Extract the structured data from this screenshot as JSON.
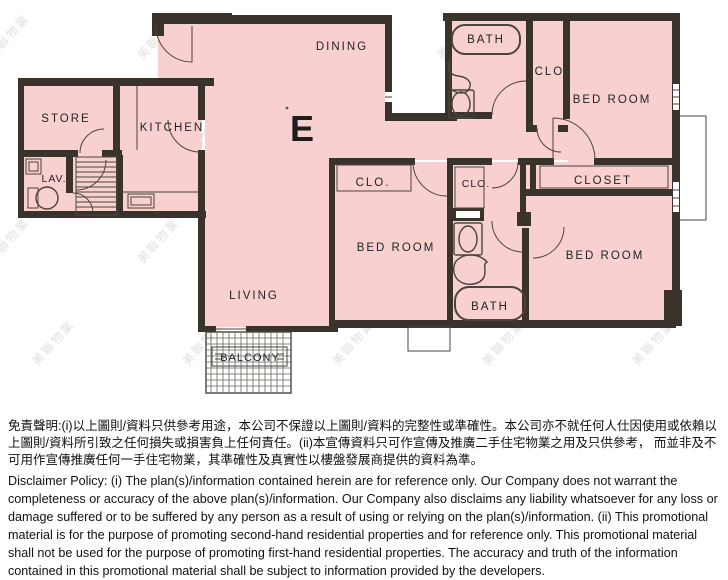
{
  "plan": {
    "unit_label": "E",
    "labels": {
      "store": "STORE",
      "kitchen": "KITCHEN",
      "lav": "LAV.",
      "dining": "DINING",
      "living": "LIVING",
      "balcony": "BALCONY",
      "bath_top": "BATH",
      "bath_bottom": "BATH",
      "clo_top": "CLO.",
      "clo_left": "CLO.",
      "clo_mid": "CLO.",
      "closet": "CLOSET",
      "bedroom_top": "BED ROOM",
      "bedroom_mid": "BED ROOM",
      "bedroom_bottom": "BED ROOM"
    },
    "colors": {
      "room_fill": "#f8d0d0",
      "wall": "#3a332c",
      "fixture_line": "#4a443c",
      "watermark": "#a8a195"
    },
    "watermark_text": "美聯物業"
  },
  "disclaimer": {
    "chinese": "免責聲明:(i)以上圖則/資料只供參考用途，本公司不保證以上圖則/資料的完整性或準確性。本公司亦不就任何人仕因使用或依賴以上圖則/資料所引致之任何損失或損害負上任何責任。(ii)本宣傳資料只可作宣傳及推廣二手住宅物業之用及只供參考， 而並非及不可用作宣傳推廣任何一手住宅物業，其準確性及真實性以樓盤發展商提供的資料為準。",
    "english": "Disclaimer Policy: (i) The plan(s)/information contained herein are for reference only. Our Company does not warrant the completeness or accuracy of the above plan(s)/information. Our Company also disclaims any liability whatsoever for any loss or damage suffered or to be suffered by any person as a result of using or relying on the plan(s)/information. (ii) This promotional material is for the purpose of promoting second-hand residential properties and for reference only. This promotional material shall not be used for the purpose of promoting first-hand residential properties. The accuracy and truth of the information contained in this promotional material shall be subject to information provided by the developers."
  }
}
